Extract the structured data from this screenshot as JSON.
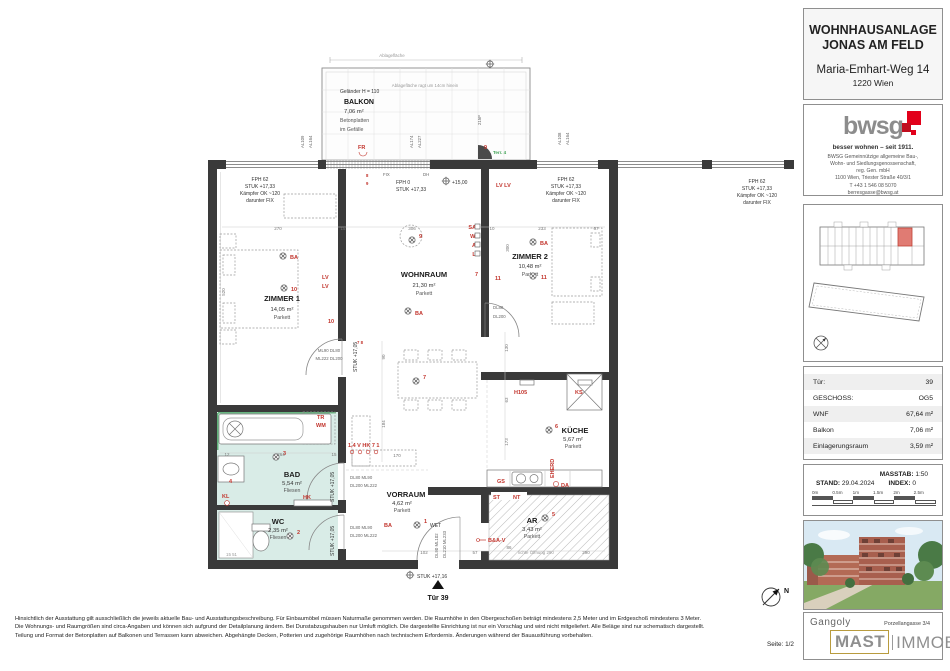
{
  "header": {
    "line1": "WOHNHAUSANLAGE",
    "line2": "JONAS AM FELD",
    "street": "Maria-Emhart-Weg 14",
    "city": "1220 Wien"
  },
  "bwsg": {
    "logo": "bwsg",
    "tagline": "besser wohnen – seit 1911.",
    "lines": [
      "BWSG Gemeinnützige allgemeine Bau-,",
      "Wohn- und Siedlungsgenossenschaft,",
      "reg. Gen. mbH",
      "1100 Wien, Triester Straße 40/3/1",
      "T +43 1 546 08 5070",
      "berresgasse@bwsg.at"
    ]
  },
  "info": {
    "rows": [
      [
        "Tür:",
        "39"
      ],
      [
        "GESCHOSS:",
        "OG5"
      ],
      [
        "WNF",
        "67,64 m²"
      ],
      [
        "Balkon",
        "7,06 m²"
      ],
      [
        "Einlagerungsraum",
        "3,59 m²"
      ]
    ]
  },
  "scale": {
    "masstab_label": "MASSTAB:",
    "masstab": "1:50",
    "stand_label": "STAND:",
    "stand": "29.04.2024",
    "index_label": "INDEX:",
    "index": "0",
    "ticks": [
      "0m",
      "0.5m",
      "1m",
      "1.5m",
      "2m",
      "2.5m"
    ]
  },
  "mast": {
    "gangoly": "Gangoly",
    "address": "Porzellangasse 3/4",
    "word1": "MAST",
    "word2": "IMMOBILIEN"
  },
  "footer": {
    "seite": "Seite: 1/2",
    "disclaimer1": "Hinsichtlich der Ausstattung gilt ausschließlich die jeweils aktuelle Bau- und Ausstattungsbeschreibung. Für Einbaumöbel müssen Naturmaße genommen werden. Die Raumhöhe in den Obergeschoßen beträgt mindestens 2,5 Meter und im Erdgeschoß mindestens 3 Meter.",
    "disclaimer2": "Die Wohnungs- und Raumgrößen sind circa-Angaben und können sich aufgrund der Detailplanung ändern. Bei Dunstabzugshauben nur Umluft möglich. Die dargestellte Einrichtung ist nur ein Vorschlag und wird nicht mitgeliefert. Alle Beläge sind nur schematisch dargestellt.",
    "disclaimer3": "Teilung und Format der Betonplatten auf Balkonen und Terrassen kann abweichen. Abgehängte Decken, Potterien und zugehörige Raumhöhen nach technischem Erfordernis. Änderungen während der Bauausführung vorbehalten."
  },
  "colors": {
    "bwsg_red": "#e2001a",
    "mast_gold": "#b89b3e",
    "wet_room_teal": "#d9ece7",
    "unit_highlight": "#e07b73",
    "annotation_red": "#c2342c",
    "accent_green": "#3fa254"
  },
  "plan": {
    "balcony": {
      "top_note": "Ablagefläche",
      "inner_note": "Ablagefläche ragt um 14cm hinein",
      "railing": "Geländer H = 110",
      "name": "BALKON",
      "area": "7,06 m²",
      "mat1": "Betonplatten",
      "mat2": "im Gefälle",
      "fr": "FR",
      "n9": "9",
      "terr": "Terr. 4"
    },
    "rooms": {
      "z1": {
        "n": "ZIMMER 1",
        "a": "14,05 m²",
        "f": "Parkett"
      },
      "wr": {
        "n": "WOHNRAUM",
        "a": "21,30 m²",
        "f": "Parkett"
      },
      "z2": {
        "n": "ZIMMER 2",
        "a": "10,48 m²",
        "f": "Parkett"
      },
      "ku": {
        "n": "KÜCHE",
        "a": "5,67 m²",
        "f": "Parkett"
      },
      "ba": {
        "n": "BAD",
        "a": "5,54 m²",
        "f": "Fliesen"
      },
      "wc": {
        "n": "WC",
        "a": "2,35 m²",
        "f": "Fliesen"
      },
      "vr": {
        "n": "VORRAUM",
        "a": "4,62 m²",
        "f": "Parkett"
      },
      "ar": {
        "n": "AR",
        "a": "3,43 m²",
        "f": "Parkett"
      }
    },
    "win": {
      "fph62": "FPH 62",
      "fph0": "FPH 0",
      "stuk1733": "STUK +17,33",
      "kaempfer": "Kämpfer OK ~120",
      "darunter": "darunter FIX",
      "fix": "FIX",
      "dh": "DH"
    },
    "lvl": {
      "stuk1705": "STUK +17,05",
      "stuk1716": "STUK +17,16",
      "plus15": "+15,00"
    },
    "door": {
      "z1a": "ML90  DL80",
      "z1b": "ML222  DL200",
      "z2a": "DL80",
      "z2b": "DL200",
      "bada": "DL80  ML90",
      "badb": "DL200  ML222",
      "weta": "DL90 ML102",
      "wetb": "DL210 ML233",
      "wet": "WET",
      "tuer": "Tür 39"
    },
    "mark": {
      "ba": "BA",
      "lv": "LV",
      "lvlv": "LV LV",
      "sat": "SAT",
      "we": "WE",
      "a1": "A1",
      "h105": "H105",
      "ks": "KS",
      "eherd": "EHERD",
      "gs": "GS",
      "da": "DA",
      "st": "ST",
      "nt": "NT",
      "tr": "TR",
      "wm": "WM",
      "kl": "KL",
      "hk": "HK",
      "bav": "B&A-V",
      "combo": "1,4 V HK 7 1",
      "n1": "1",
      "n2": "2",
      "n3": "3",
      "n5": "5",
      "n6": "6",
      "n7": "7",
      "n8": "8",
      "n9": "9",
      "n10": "10",
      "n11": "11",
      "n4": "4",
      "n78": "7 8"
    },
    "al": {
      "a": "AL109",
      "b": "AL164",
      "c": "AL174",
      "d": "AL227",
      "e": "215P",
      "f": "AL108",
      "g": "AL164"
    },
    "dims": [
      "270",
      "15",
      "306",
      "10",
      "233",
      "67",
      "300",
      "520",
      "90",
      "184",
      "170",
      "130",
      "63",
      "173",
      "102",
      "57",
      "86",
      "290",
      "12",
      "264",
      "15"
    ],
    "misc": {
      "north": "N",
      "oeffnung": "lichte Öffnung  290",
      "shaft": "15  51"
    }
  }
}
